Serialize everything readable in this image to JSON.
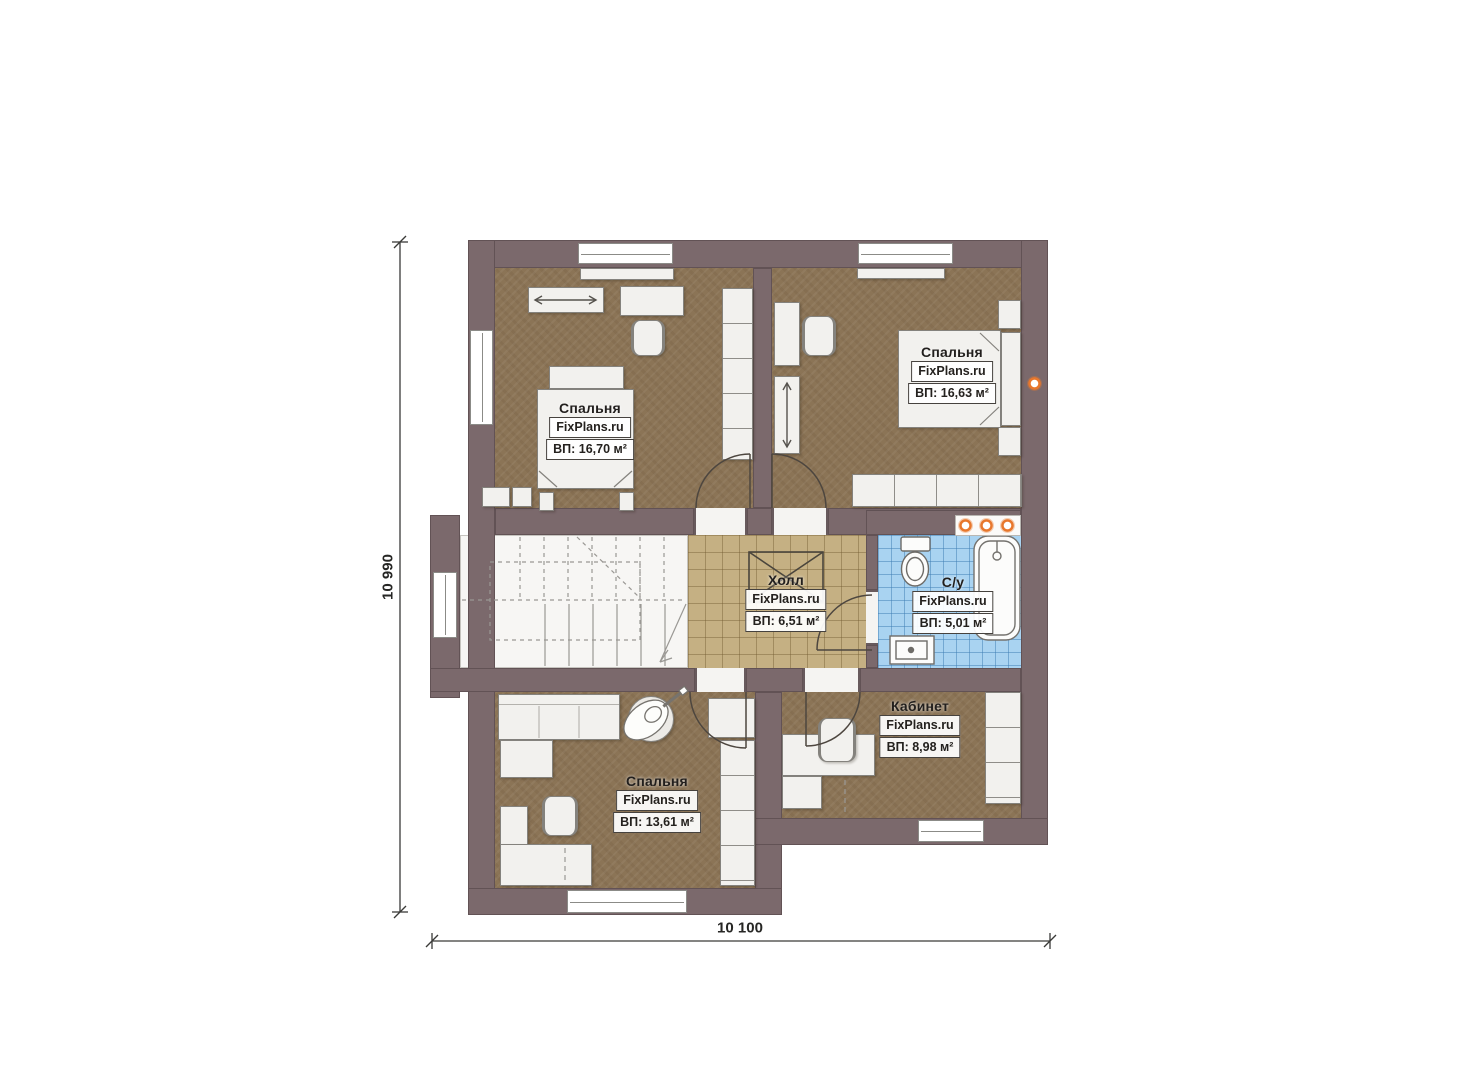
{
  "dimensions": {
    "height": "10 990",
    "width": "10 100"
  },
  "rooms": [
    {
      "name": "Спальня",
      "brand": "FixPlans.ru",
      "area": "ВП: 16,70 м²"
    },
    {
      "name": "Спальня",
      "brand": "FixPlans.ru",
      "area": "ВП: 16,63 м²"
    },
    {
      "name": "Холл",
      "brand": "FixPlans.ru",
      "area": "ВП: 6,51 м²"
    },
    {
      "name": "С/у",
      "brand": "FixPlans.ru",
      "area": "ВП: 5,01 м²"
    },
    {
      "name": "Спальня",
      "brand": "FixPlans.ru",
      "area": "ВП: 13,61 м²"
    },
    {
      "name": "Кабинет",
      "brand": "FixPlans.ru",
      "area": "ВП: 8,98 м²"
    }
  ],
  "colors": {
    "wall": "#7b696c",
    "bedroom_floor": "#8b7456",
    "hall_tile": "#c5b083",
    "bath_tile": "#a9d3f1",
    "accent_orange": "#e8772c"
  }
}
